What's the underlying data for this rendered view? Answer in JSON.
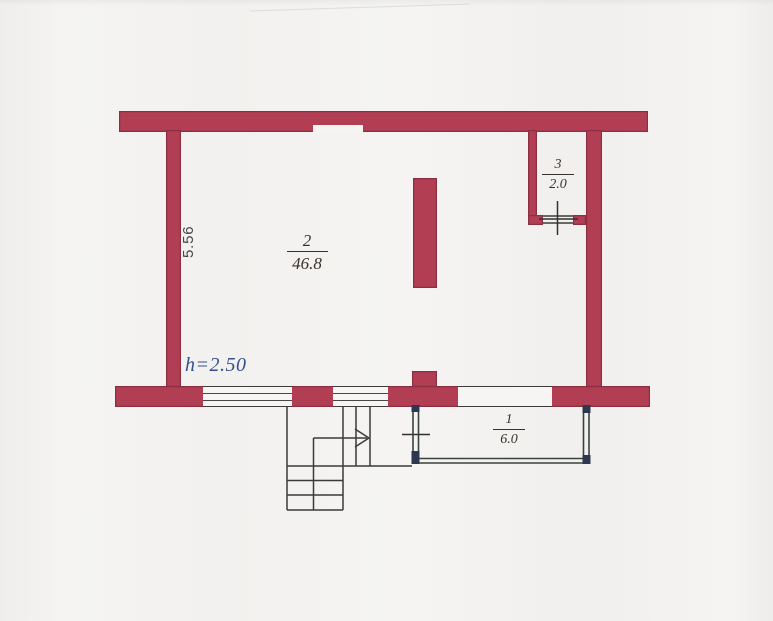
{
  "plan": {
    "title_hint": "apartment-floor-plan-scan",
    "height_label": "h=2.50",
    "left_dimension": "5.56",
    "rooms": [
      {
        "number": "2",
        "area": "46.8"
      },
      {
        "number": "3",
        "area": "2.0"
      },
      {
        "number": "1",
        "area": "6.0"
      }
    ],
    "colors": {
      "wall_fill": "#b23e54",
      "wall_outline": "#5d1c2c",
      "line": "#3a3a3a",
      "annex_line": "#39423f",
      "annex_corner": "#2d3850",
      "label_text": "#39322c",
      "height_text": "#31508d",
      "paper": "#f5f4f2"
    }
  }
}
